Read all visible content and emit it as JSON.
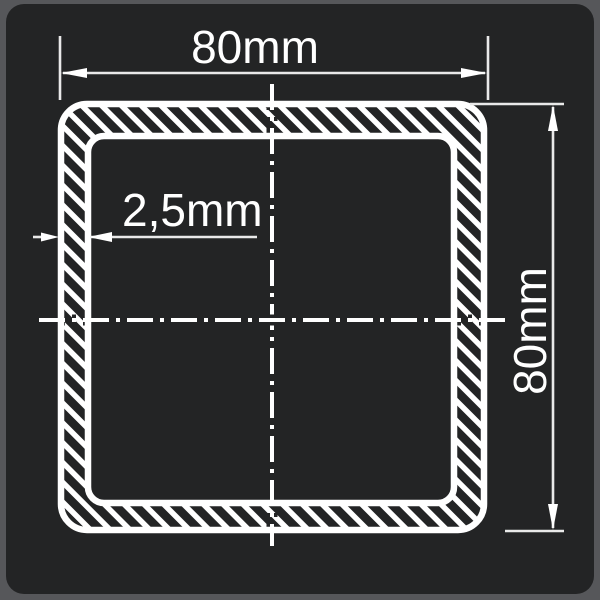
{
  "drawing": {
    "type": "technical-cross-section",
    "subject": "square hollow tube profile",
    "dimensions": {
      "width_label": "80mm",
      "height_label": "80mm",
      "thickness_label": "2,5mm"
    },
    "colors": {
      "canvas_background": "#56575A",
      "panel_background": "#232425",
      "line_ink": "#FFFFFF",
      "thin_line_ink": "#E9E9E9"
    }
  }
}
